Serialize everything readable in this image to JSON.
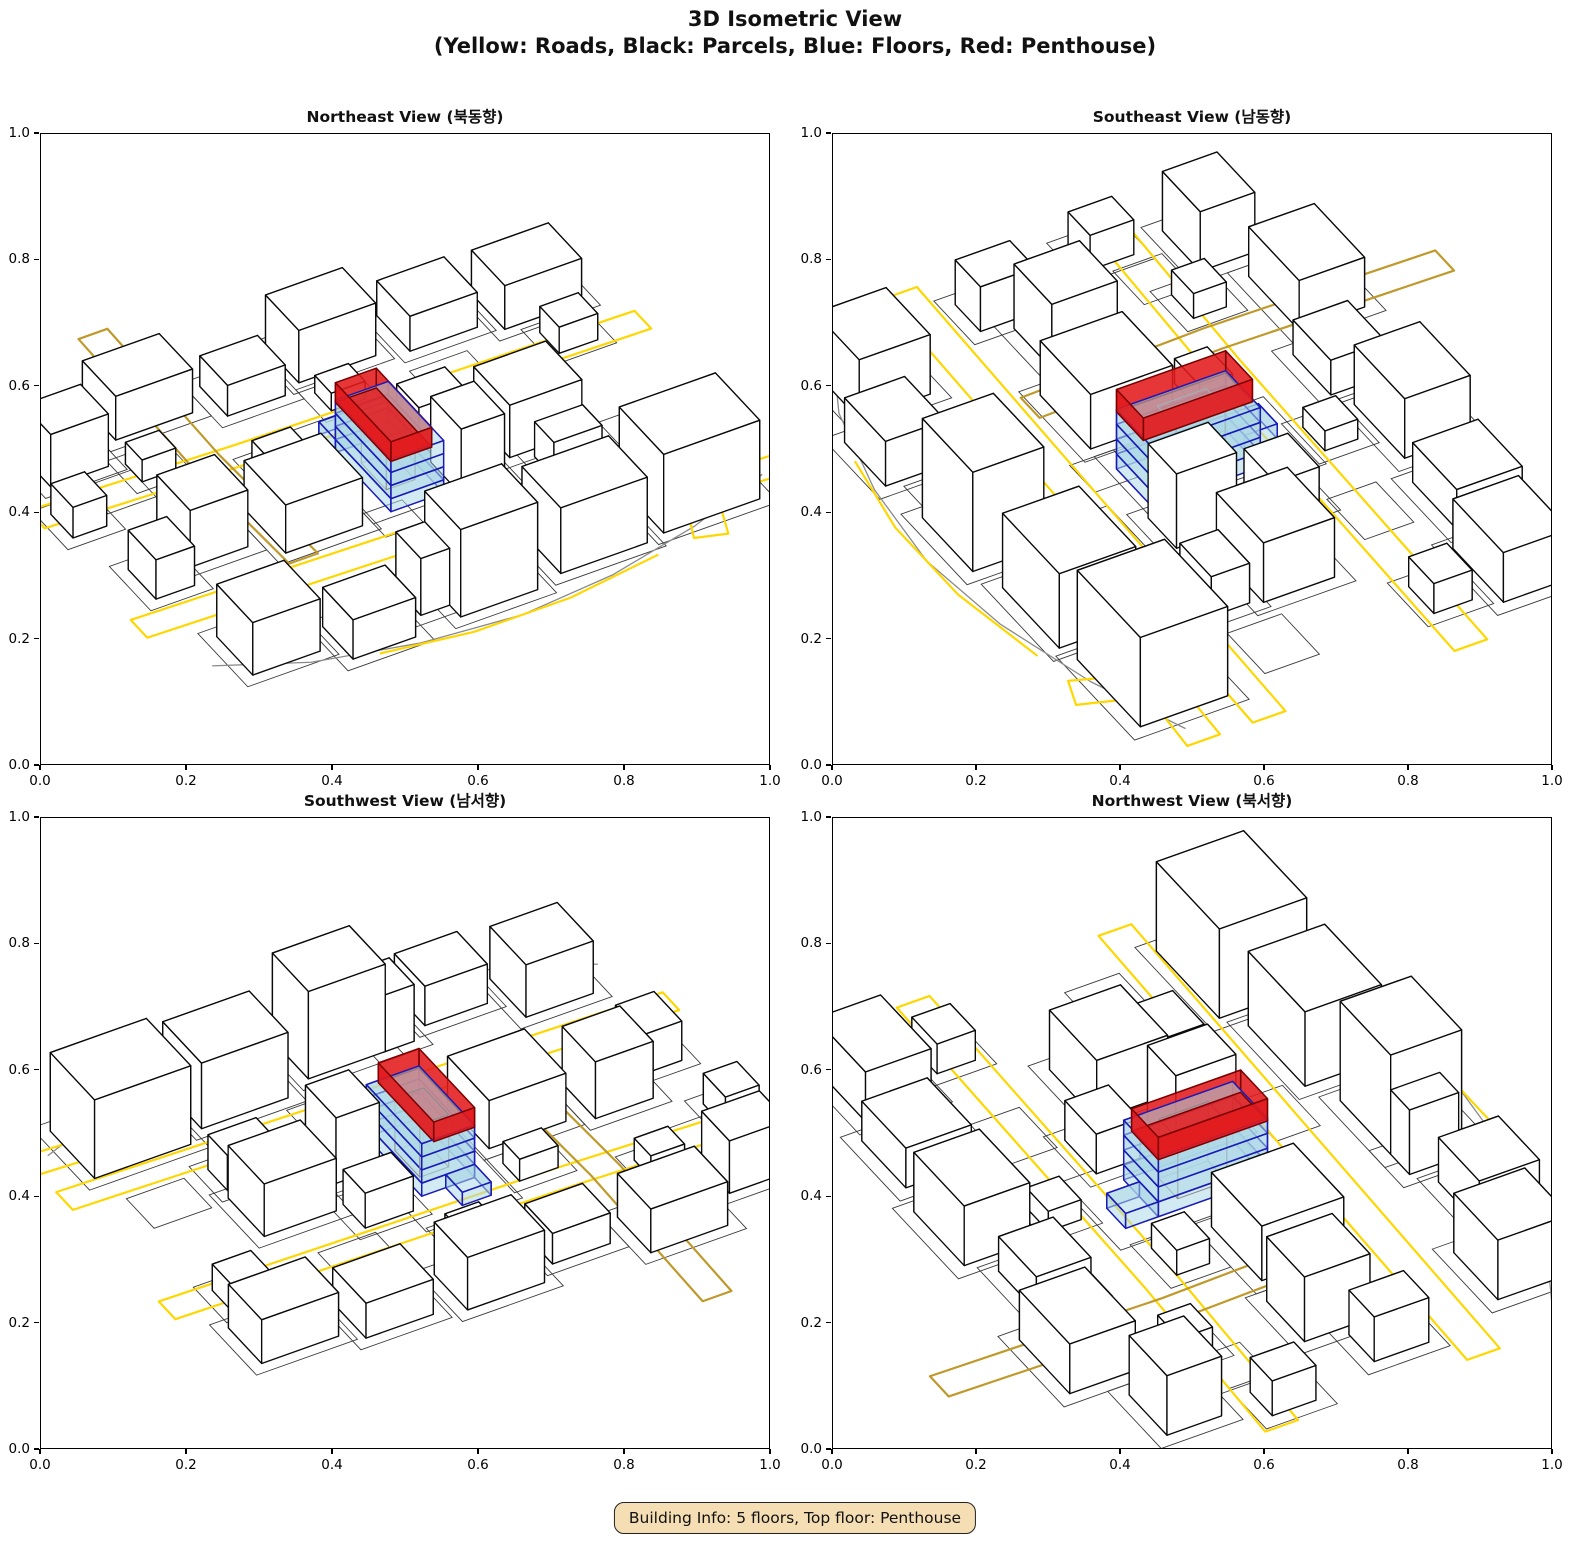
{
  "figure": {
    "title_line1": "3D Isometric View",
    "title_line2": "(Yellow: Roads, Black: Parcels, Blue: Floors, Red: Penthouse)"
  },
  "badge": {
    "text": "Building Info: 5 floors, Top floor: Penthouse",
    "bg_color": "#f5deb3",
    "border_color": "#222222"
  },
  "chart_data": {
    "type": "3d-isometric-multiview",
    "title": "3D Isometric View",
    "subtitle": "(Yellow: Roads, Black: Parcels, Blue: Floors, Red: Penthouse)",
    "building_info": {
      "floors": 5,
      "top_floor": "Penthouse"
    },
    "legend": {
      "roads": "Yellow",
      "parcels": "Black",
      "floors": "Blue",
      "penthouse": "Red"
    },
    "elevation_deg": 38,
    "axes": {
      "xlim": [
        0,
        1
      ],
      "ylim": [
        0,
        1
      ],
      "tick_labels": [
        "0.0",
        "0.2",
        "0.4",
        "0.6",
        "0.8",
        "1.0"
      ],
      "tick_values": [
        0,
        0.2,
        0.4,
        0.6,
        0.8,
        1.0
      ]
    },
    "views": [
      {
        "title": "Northeast View (북동향)",
        "azimuth_deg": 60
      },
      {
        "title": "Southeast View (남동향)",
        "azimuth_deg": 150
      },
      {
        "title": "Southwest View (남서향)",
        "azimuth_deg": 240
      },
      {
        "title": "Northwest View (북서향)",
        "azimuth_deg": 330
      }
    ],
    "colors": {
      "road_bright": "#FFD700",
      "road_dark": "#C0992B",
      "parcel_line": "#3a3a3a",
      "boundary_line": "#8a8a8a",
      "building_fill": "#ffffff",
      "building_edge": "#0a0a0a",
      "floor_fill": "rgba(173,216,230,0.55)",
      "floor_edge": "#1a1ab8",
      "penthouse_fill": "rgba(227,26,28,0.88)",
      "penthouse_edge": "#7a0000",
      "core_edge": "#8a8a8a"
    },
    "scene": {
      "context_buildings": [
        [
          -54,
          24,
          20,
          16,
          18
        ],
        [
          -30,
          27,
          18,
          14,
          15
        ],
        [
          -6,
          30,
          16,
          13,
          20
        ],
        [
          10,
          30,
          6,
          9,
          13
        ],
        [
          20,
          33,
          13,
          11,
          9
        ],
        [
          37,
          26,
          14,
          13,
          12
        ],
        [
          -36,
          -6,
          15,
          13,
          12
        ],
        [
          -35,
          9,
          10,
          7,
          8
        ],
        [
          -17,
          1,
          9,
          11,
          15
        ],
        [
          -19,
          -13,
          10,
          8,
          8
        ],
        [
          12,
          -4,
          16,
          15,
          11
        ],
        [
          33,
          -6,
          12,
          12,
          13
        ],
        [
          47,
          1,
          8,
          10,
          9
        ],
        [
          12,
          -15,
          8,
          6,
          5
        ],
        [
          -55,
          -38,
          16,
          12,
          10
        ],
        [
          -35,
          -41,
          14,
          12,
          8
        ],
        [
          -15,
          -43,
          16,
          12,
          12
        ],
        [
          5,
          -39,
          12,
          10,
          7
        ],
        [
          22,
          -45,
          16,
          12,
          10
        ],
        [
          43,
          -37,
          12,
          10,
          12
        ],
        [
          -7,
          -27,
          7,
          6,
          4
        ],
        [
          33,
          -26,
          7,
          6,
          5
        ],
        [
          52,
          -20,
          7,
          8,
          7
        ],
        [
          -52,
          -22,
          8,
          7,
          6
        ]
      ],
      "parcel_margin": 2.5,
      "extra_parcels": [
        [
          -52,
          6,
          12,
          10
        ],
        [
          2,
          8,
          8,
          8
        ],
        [
          40,
          -24,
          10,
          9
        ],
        [
          -30,
          -24,
          12,
          9
        ],
        [
          -14,
          16,
          12,
          8
        ]
      ],
      "target_parcel": [
        -10,
        -19.5,
        20,
        31
      ],
      "roads": [
        {
          "color": "bright",
          "closed": true,
          "points": [
            [
              -62,
              -13
            ],
            [
              20,
              -15
            ],
            [
              62,
              -17
            ],
            [
              62,
              -23
            ],
            [
              20,
              -21
            ],
            [
              -62,
              -19
            ]
          ]
        },
        {
          "color": "bright",
          "closed": true,
          "points": [
            [
              -62,
              18
            ],
            [
              0,
              16
            ],
            [
              62,
              14
            ],
            [
              62,
              20
            ],
            [
              0,
              22
            ],
            [
              -62,
              24
            ]
          ]
        },
        {
          "color": "dark",
          "closed": true,
          "points": [
            [
              23,
              -62
            ],
            [
              24,
              -20
            ],
            [
              23,
              14
            ],
            [
              29,
              14
            ],
            [
              30,
              -20
            ],
            [
              29,
              -62
            ]
          ]
        },
        {
          "color": "bright",
          "closed": true,
          "points": [
            [
              -62,
              30
            ],
            [
              -44,
              29
            ],
            [
              -38,
              44
            ],
            [
              -44,
              46
            ],
            [
              -48,
              35
            ],
            [
              -62,
              36
            ]
          ]
        }
      ],
      "boundary_arcs": [
        {
          "color": "gray",
          "points": [
            [
              -58,
              34
            ],
            [
              -40,
              41
            ],
            [
              -20,
              46
            ],
            [
              0,
              48
            ],
            [
              20,
              46
            ],
            [
              40,
              41
            ],
            [
              56,
              33
            ]
          ]
        },
        {
          "color": "bright",
          "points": [
            [
              -30,
              45
            ],
            [
              -10,
              48
            ],
            [
              10,
              48
            ],
            [
              28,
              45
            ]
          ]
        }
      ],
      "target_building": {
        "floor_rect": [
          -5.5,
          -10,
          11,
          20
        ],
        "floor_heights": [
          [
            0,
            3
          ],
          [
            3,
            6
          ],
          [
            6,
            9
          ],
          [
            9,
            12
          ]
        ],
        "annex": {
          "rect": [
            -0.5,
            -16,
            6,
            6
          ],
          "z": [
            0,
            3
          ]
        },
        "core": {
          "rect": [
            -3,
            -5,
            6,
            9
          ],
          "z": [
            0,
            12
          ]
        },
        "penthouse": {
          "rect": [
            -3,
            -10,
            8.5,
            20
          ],
          "z": [
            11.5,
            16
          ],
          "hollow": true
        }
      }
    }
  }
}
